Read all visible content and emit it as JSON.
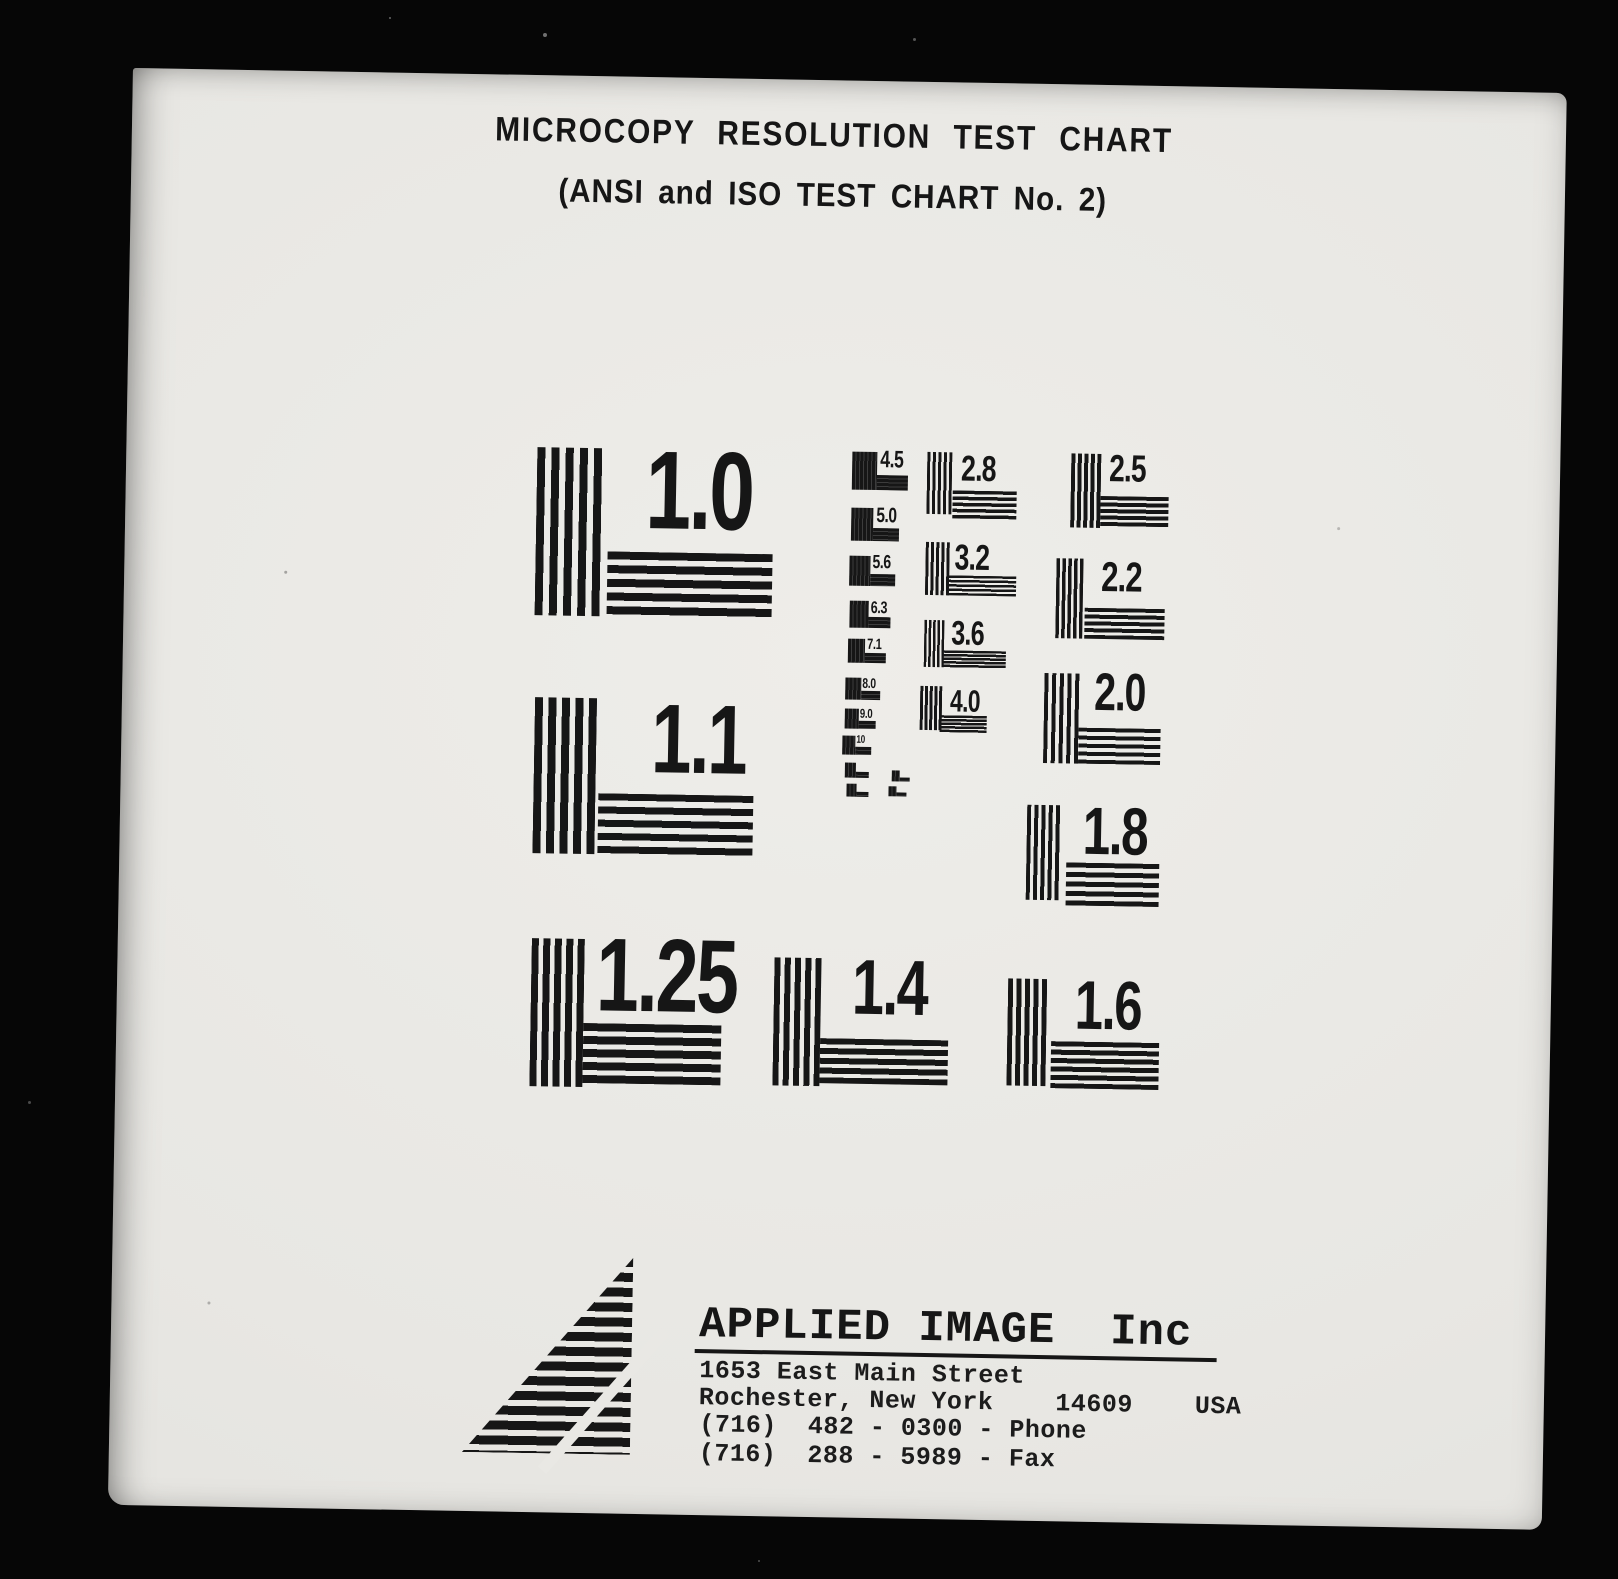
{
  "header": {
    "title": "MICROCOPY RESOLUTION TEST CHART",
    "subtitle": "(ANSI and ISO TEST CHART No. 2)"
  },
  "targets": {
    "large": [
      {
        "label": "1.0"
      },
      {
        "label": "1.1"
      },
      {
        "label": "1.25"
      },
      {
        "label": "1.4"
      },
      {
        "label": "1.6"
      },
      {
        "label": "1.8"
      },
      {
        "label": "2.0"
      },
      {
        "label": "2.2"
      },
      {
        "label": "2.5"
      },
      {
        "label": "2.8"
      },
      {
        "label": "3.2"
      },
      {
        "label": "3.6"
      },
      {
        "label": "4.0"
      }
    ],
    "small": [
      {
        "label": "4.5"
      },
      {
        "label": "5.0"
      },
      {
        "label": "5.6"
      },
      {
        "label": "6.3"
      },
      {
        "label": "7.1"
      },
      {
        "label": "8.0"
      },
      {
        "label": "9.0"
      },
      {
        "label": "10"
      },
      {
        "label": ""
      },
      {
        "label": ""
      },
      {
        "label": ""
      },
      {
        "label": ""
      }
    ]
  },
  "footer": {
    "company": "APPLIED IMAGE  Inc",
    "address_line1": "1653 East Main Street",
    "address_line2": "Rochester, New York    14609    USA",
    "phone": "(716)  482 - 0300 - Phone",
    "fax": "(716)  288 - 5989 - Fax"
  },
  "colors": {
    "background": "#060606",
    "paper": "#e9e8e4",
    "ink": "#161616"
  }
}
